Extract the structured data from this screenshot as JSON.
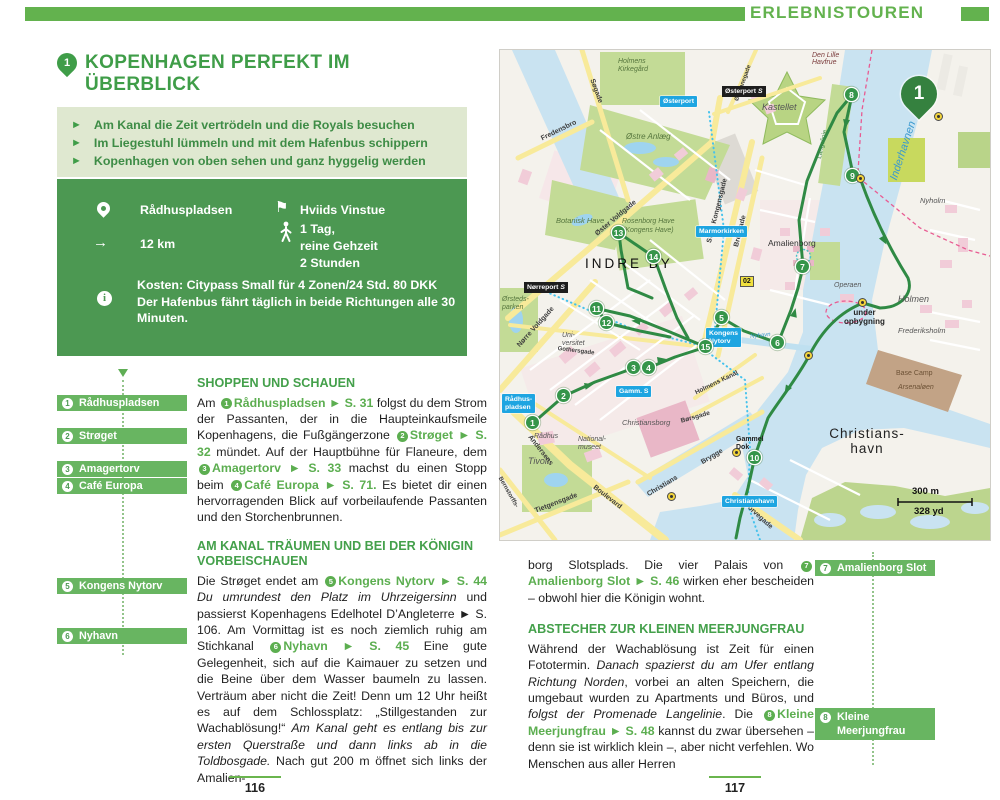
{
  "header": {
    "title": "ERLEBNISTOUREN"
  },
  "left_page": {
    "badge": "1",
    "title": "KOPENHAGEN PERFEKT IM ÜBERBLICK",
    "highlights": [
      "Am Kanal die Zeit vertrödeln und die Royals besuchen",
      "Im Liegestuhl lümmeln und mit dem Hafenbus schippern",
      "Kopenhagen von oben sehen und ganz hyggelig werden"
    ],
    "bullet": "►",
    "info": {
      "start": "Rådhuspladsen",
      "finish": "Hviids Vinstue",
      "distance": "12 km",
      "distance_arrow": "→",
      "flag": "⚑",
      "duration": "1 Tag,\nreine Gehzeit\n2 Stunden",
      "notes": "Kosten: Citypass Small für 4 Zonen/24 Std. 80 DKK\nDer Hafenbus fährt täglich in beide Richtungen alle 30 Minuten."
    },
    "margin_labels": [
      {
        "n": "1",
        "label": "Rådhuspladsen"
      },
      {
        "n": "2",
        "label": "Strøget"
      },
      {
        "n": "3",
        "label": "Amagertorv"
      },
      {
        "n": "4",
        "label": "Café Europa"
      },
      {
        "n": "5",
        "label": "Kongens Nytorv"
      },
      {
        "n": "6",
        "label": "Nyhavn"
      }
    ],
    "s1": {
      "h": "SHOPPEN UND SCHAUEN",
      "p": [
        "Am ",
        "1",
        "Rådhuspladsen",
        " ► S. 31",
        " folgst du dem Strom der Passanten, der in die Haupteinkaufsmeile Kopenhagens, die Fußgängerzone ",
        "2",
        "Strøget",
        " ► S. 32",
        " mündet. Auf der Hauptbühne für Flaneure, dem ",
        "3",
        "Amagertorv",
        " ► S. 33",
        " machst du einen Stopp beim ",
        "4",
        "Café Europa",
        " ► S. 71.",
        " Es bietet dir einen hervorragenden Blick auf vorbeilaufende Passanten und den Storchenbrunnen."
      ]
    },
    "s2": {
      "h": "AM KANAL TRÄUMEN UND BEI DER KÖNIGIN VORBEISCHAUEN",
      "p": [
        "Die Strøget endet am ",
        "5",
        "Kongens Nytorv",
        " ► S. 44",
        " Du umrundest den Platz im Uhrzeigersinn",
        " und passierst Kopenhagens Edelhotel D’Angleterre ► S. 106. Am Vormittag ist es noch ziemlich ruhig am Stichkanal ",
        "6",
        "Nyhavn",
        " ► S. 45",
        " Eine gute Gelegenheit, sich auf die Kaimauer zu setzen und die Beine über dem Wasser baumeln zu lassen. Verträum aber nicht die Zeit! Denn um 12 Uhr heißt es auf dem Schlossplatz: „Stillgestanden zur Wachablösung!“ ",
        "Am Kanal geht es entlang bis zur ersten Querstraße und dann links ab in die Toldbosgade.",
        " Nach gut 200 m öffnet sich links der Amalien-"
      ]
    },
    "page_number": "116"
  },
  "right_page": {
    "s1": {
      "p": [
        "borg Slotsplads. Die vier Palais von ",
        "7",
        "Amalienborg Slot",
        " ► S. 46",
        " wirken eher bescheiden – obwohl hier die Königin wohnt."
      ]
    },
    "s2": {
      "h": "ABSTECHER ZUR KLEINEN MEERJUNGFRAU",
      "p": [
        "Während der Wachablösung ist Zeit für einen Fototermin. ",
        "Danach spazierst du am Ufer entlang Richtung Norden",
        ", vorbei an alten Speichern, die umgebaut wurden zu Apartments und Büros, und ",
        "folgst der Promenade Langelinie",
        ". Die ",
        "8",
        "Kleine Meerjungfrau",
        " ► S. 48",
        " kannst du zwar übersehen – denn sie ist wirklich klein –, aber nicht verfehlen. Wo Menschen aus aller Herren"
      ]
    },
    "margin_labels": [
      {
        "n": "7",
        "label": "Amalienborg Slot"
      },
      {
        "n": "8",
        "label": "Kleine Meerjungfrau"
      }
    ],
    "page_number": "117"
  },
  "map": {
    "pin_number": "1",
    "stop_numbers": [
      "1",
      "2",
      "3",
      "4",
      "5",
      "6",
      "7",
      "8",
      "9",
      "10",
      "11",
      "12",
      "13",
      "14",
      "15"
    ],
    "stations_blue": {
      "raadhuspladsen": "Rådhus-\npladsen",
      "gammel_strand": "Gamm. S",
      "kongens_nytorv": "Kongens\nNytorv",
      "marmorkirken": "Marmorkirken",
      "oesterport": "Østerport",
      "christianshavn": "Christianshavn"
    },
    "stations_black": {
      "noerreport": "Nørreport",
      "oesterport": "Østerport"
    },
    "s_symbol": "S",
    "bus_line_badge": "02",
    "scale_m": "300 m",
    "scale_yd": "328 yd",
    "labels": {
      "indre_by": "INDRE BY",
      "christianshavn": "Christians-\nhavn",
      "kastellet": "Kastellet",
      "amalienborg": "Amalienborg",
      "holmen": "Holmen",
      "nyholm": "Nyholm",
      "frederiksholm": "Frederiksholm",
      "operaen": "Operaen",
      "base_camp": "Base Camp",
      "arsenaloen": "Arsenaløen",
      "gammel_dok": "Gammel\nDok",
      "under_opbygning": "under\nopbygning",
      "tivoli": "Tivoli",
      "christiansborg": "Christiansborg",
      "nationalmuseet": "National-\nmuseet",
      "raadhus": "Rådhus",
      "universitet": "Uni-\nversitet",
      "oerstedsparken": "Ørsteds-\nparken",
      "botanisk_have": "Botanisk Have",
      "kongens_have": "Rosenborg Have\n(Kongens Have)",
      "oestre_anlaeg": "Østre Anlæg",
      "holmens_kirkegaard": "Holmens\nKirkegård",
      "inderhavnen": "Inderhavnen",
      "langelinie": "Langelinie",
      "nyhavn": "Nyhavn",
      "den_lille_havfrue": "Den Lille\nHavfrue"
    },
    "streets": {
      "soegade": "Søgade",
      "fredensbro": "Fredensbro",
      "oester_voldgade": "Øster Voldgade",
      "store_kongensgade": "Store Kongensgade",
      "bredgade": "Bredgade",
      "noerre_voldgade": "Nørre Voldgade",
      "gothersgade": "Gothersgade",
      "andersens": "Andersens",
      "boulevard": "Boulevard",
      "tietgensgade": "Tietgensgade",
      "bernstorffsgade": "Bernstorffs-",
      "christians": "Christians",
      "brygge": "Brygge",
      "boersgade": "Børsgade",
      "holmens_kanal": "Holmens Kanal",
      "torvegade": "Torvegade",
      "oestbanegade": "Østbanegade"
    }
  }
}
